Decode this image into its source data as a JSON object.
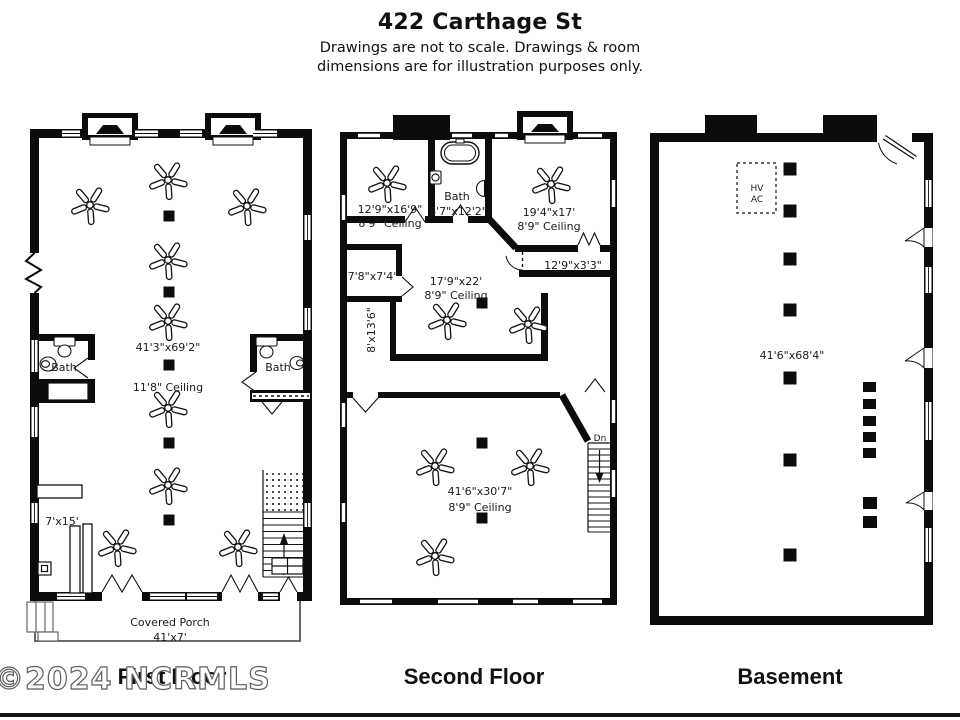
{
  "header": {
    "title": "422 Carthage St",
    "disclaimer_line1": "Drawings are not to scale. Drawings & room",
    "disclaimer_line2": "dimensions are for illustration purposes only."
  },
  "watermark_text": "©2024 NCRMLS",
  "colors": {
    "wall": "#000000",
    "background": "#ffffff",
    "text": "#1a1a1a"
  },
  "floors": {
    "first": {
      "caption": "First Floor",
      "labels": {
        "main_dims": "41'3\"x69'2\"",
        "ceiling": "11'8\" Ceiling",
        "bath": "Bath",
        "bar_area": "7'x15'",
        "porch_name": "Covered Porch",
        "porch_dims": "41'x7'"
      }
    },
    "second": {
      "caption": "Second Floor",
      "labels": {
        "room_tl_dims": "12'9\"x16'9\"",
        "room_tl_ceiling": "8'9\" Ceiling",
        "bath_name": "Bath",
        "bath_dims": "8'7\"x12'2\"",
        "room_tr_dims": "19'4\"x17'",
        "room_tr_ceiling": "8'9\" Ceiling",
        "closet_dims": "12'9\"x3'3\"",
        "room_left_dims": "7'8\"x7'4\"",
        "hall_dims": "8'x13'6\"",
        "center_dims": "17'9\"x22'",
        "center_ceiling": "8'9\" Ceiling",
        "bottom_dims": "41'6\"x30'7\"",
        "bottom_ceiling": "8'9\" Ceiling",
        "stairs_down": "Dn"
      }
    },
    "basement": {
      "caption": "Basement",
      "labels": {
        "hvac_line1": "HV",
        "hvac_line2": "AC",
        "main_dims": "41'6\"x68'4\""
      }
    }
  }
}
